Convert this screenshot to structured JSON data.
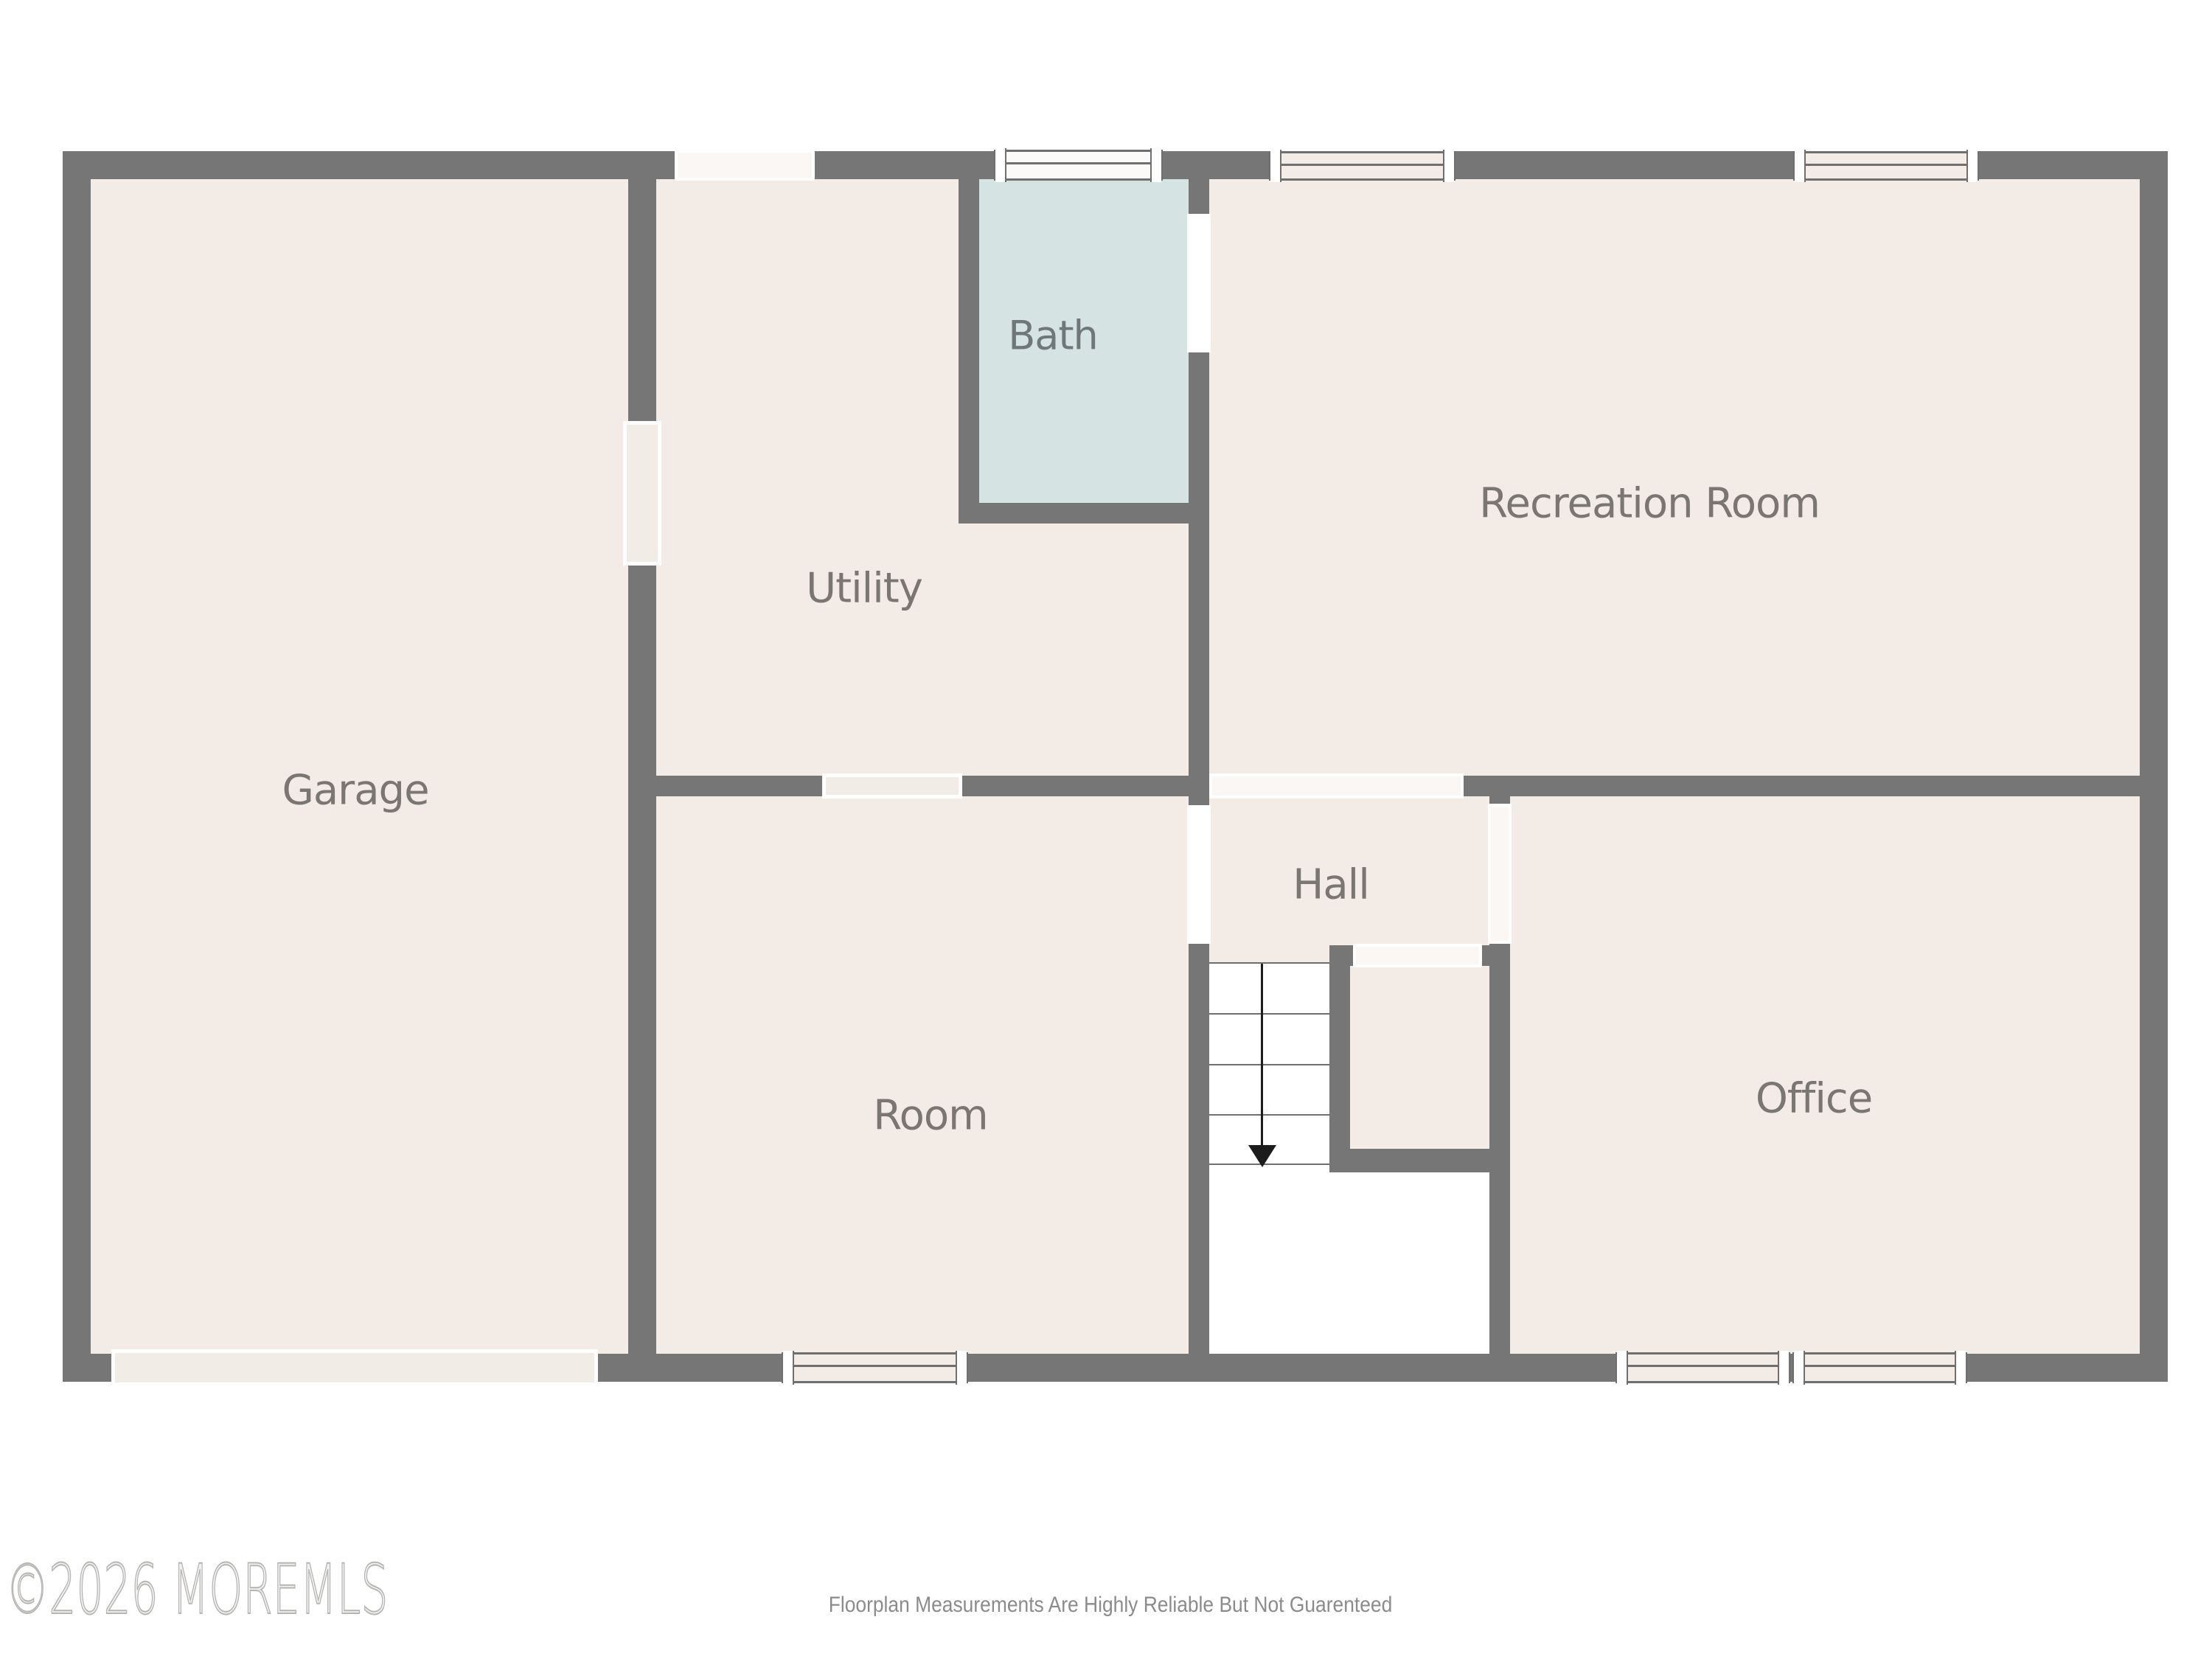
{
  "floorplan": {
    "rooms": {
      "garage": {
        "label": "Garage"
      },
      "utility": {
        "label": "Utility"
      },
      "bath": {
        "label": "Bath"
      },
      "recreation": {
        "label": "Recreation Room"
      },
      "hall": {
        "label": "Hall"
      },
      "room": {
        "label": "Room"
      },
      "office": {
        "label": "Office"
      }
    },
    "stairs": {
      "direction": "down",
      "icon": "down-arrow-icon"
    },
    "colors": {
      "wall": "#767676",
      "floor": "#f2ebe6",
      "bath_floor": "#d6e3e3",
      "background": "#ffffff",
      "label_text": "#7a7672"
    },
    "footer": {
      "watermark": "©2026 MOREMLS",
      "disclaimer": "Floorplan Measurements Are Highly Reliable But Not Guarenteed"
    }
  }
}
